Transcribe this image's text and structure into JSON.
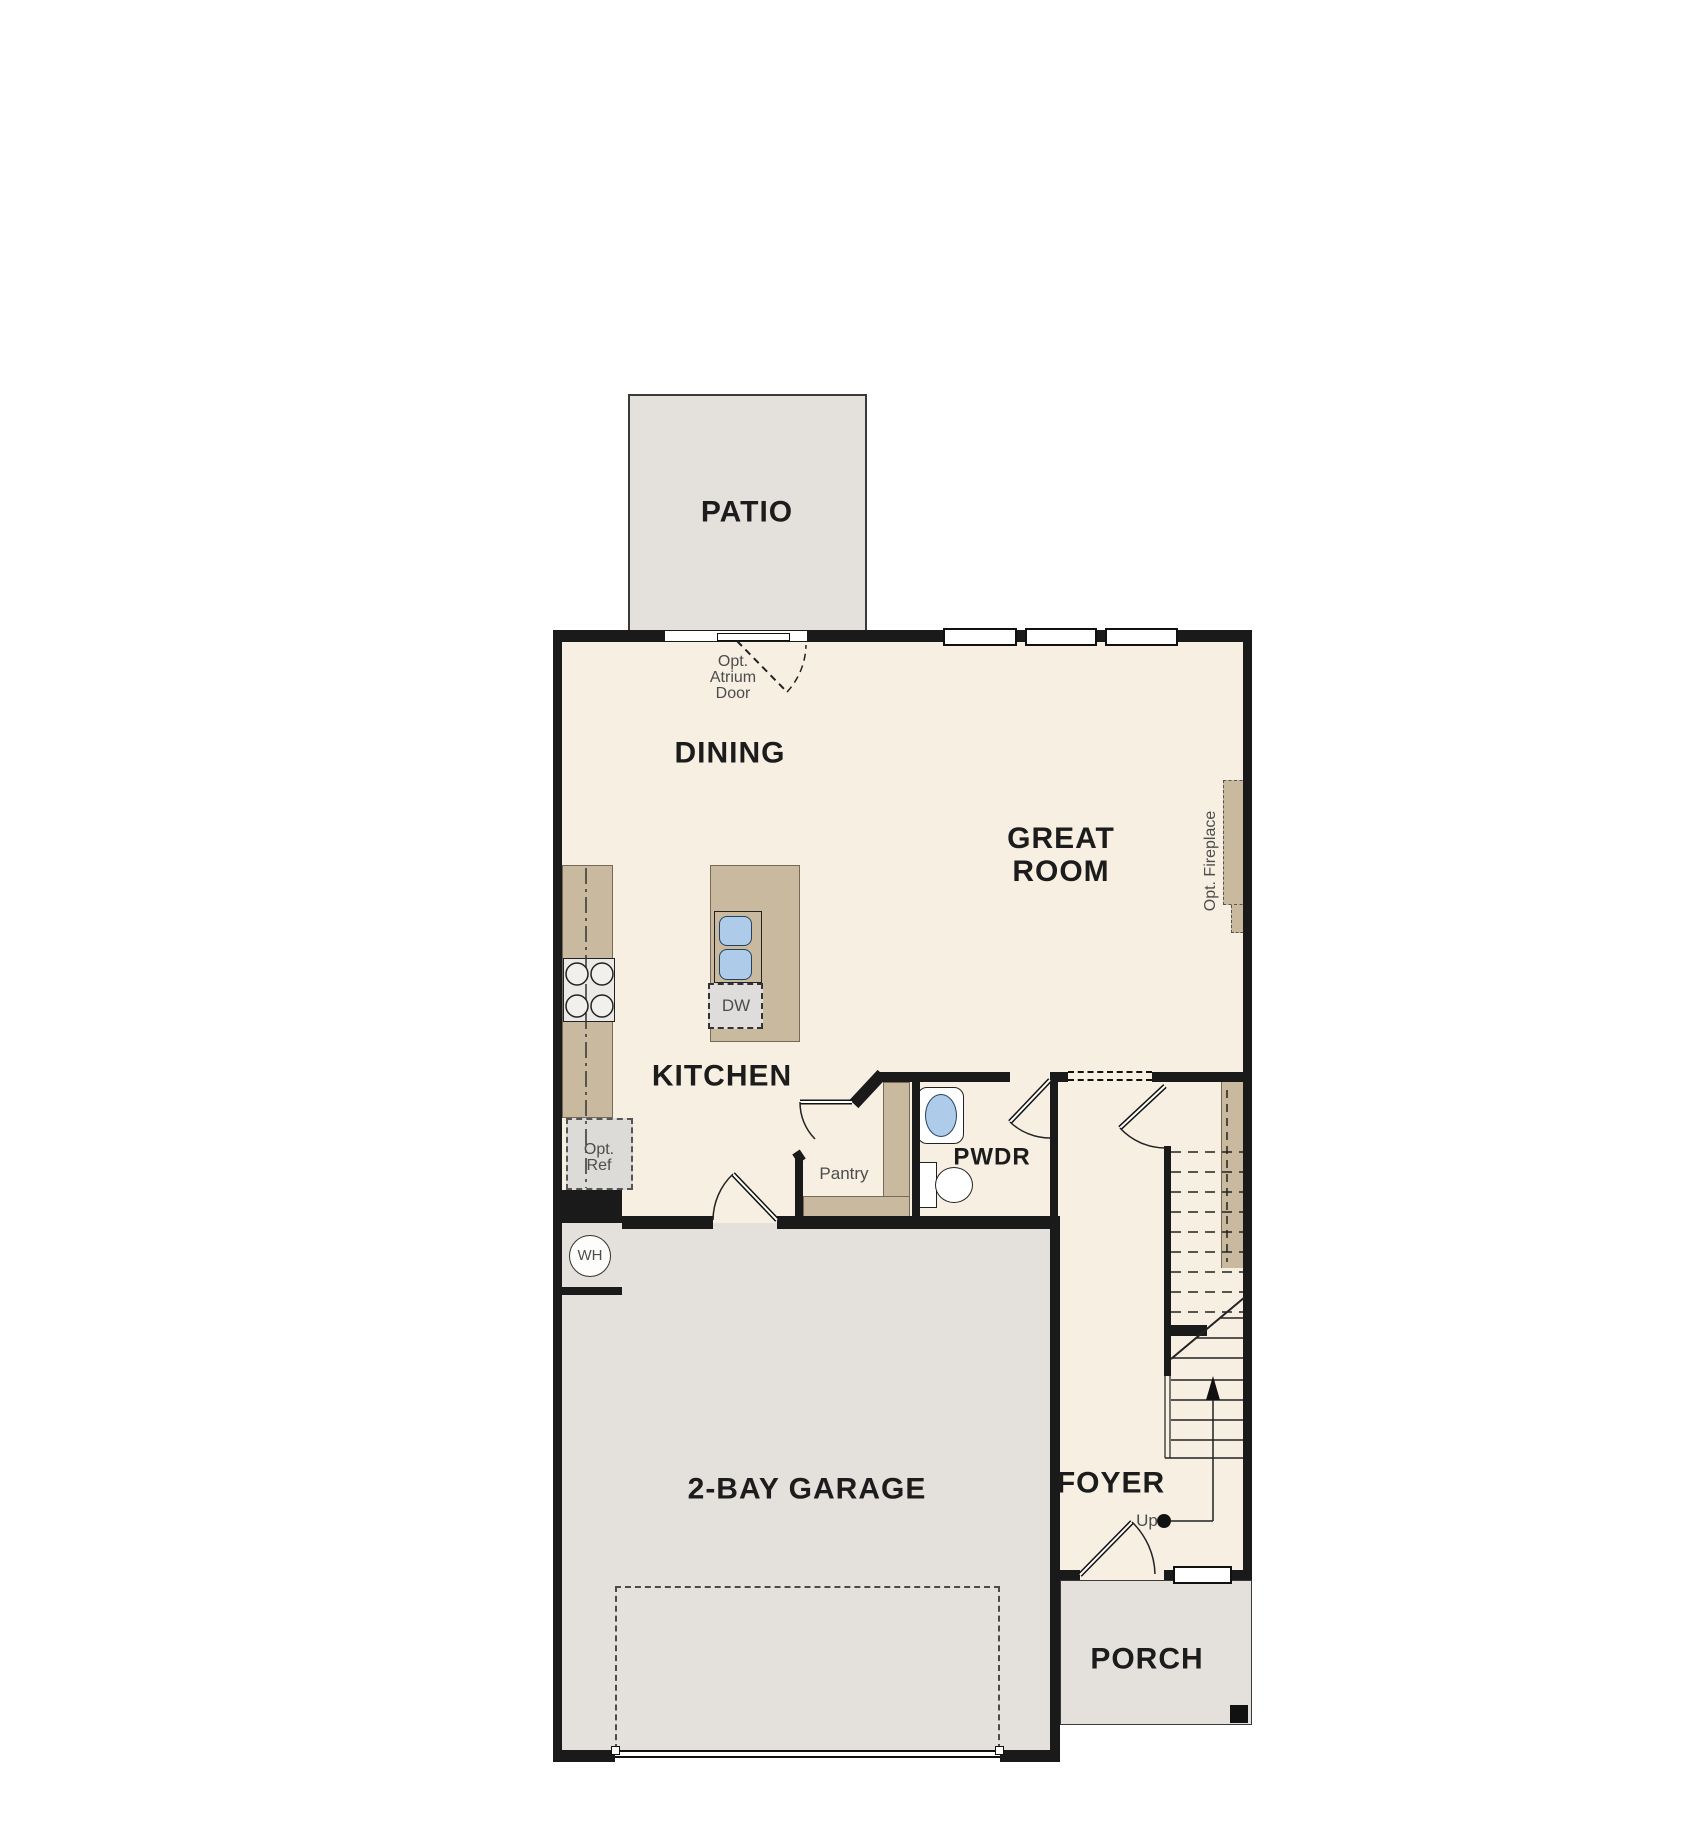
{
  "rooms": {
    "patio": {
      "label": "PATIO"
    },
    "dining": {
      "label": "DINING"
    },
    "great_room": {
      "label_line1": "GREAT",
      "label_line2": "ROOM"
    },
    "kitchen": {
      "label": "KITCHEN"
    },
    "powder": {
      "label": "PWDR"
    },
    "pantry": {
      "label": "Pantry"
    },
    "foyer": {
      "label": "FOYER"
    },
    "garage": {
      "label": "2-BAY GARAGE"
    },
    "porch": {
      "label": "PORCH"
    }
  },
  "options": {
    "atrium_door": {
      "line1": "Opt.",
      "line2": "Atrium",
      "line3": "Door"
    },
    "refrigerator": {
      "line1": "Opt.",
      "line2": "Ref"
    },
    "fireplace": {
      "label": "Opt. Fireplace"
    }
  },
  "fixtures": {
    "water_heater": {
      "label": "WH"
    },
    "dishwasher": {
      "label": "DW"
    },
    "stairs": {
      "direction_label": "Up"
    }
  },
  "colors": {
    "interior_floor": "#f6efe2",
    "exterior_floor": "#e4e1dd",
    "wall": "#1a1a1a",
    "casework_tan": "#c9b99f",
    "sink_blue": "#aecce9",
    "annotation_gray": "#4d4d4d"
  }
}
